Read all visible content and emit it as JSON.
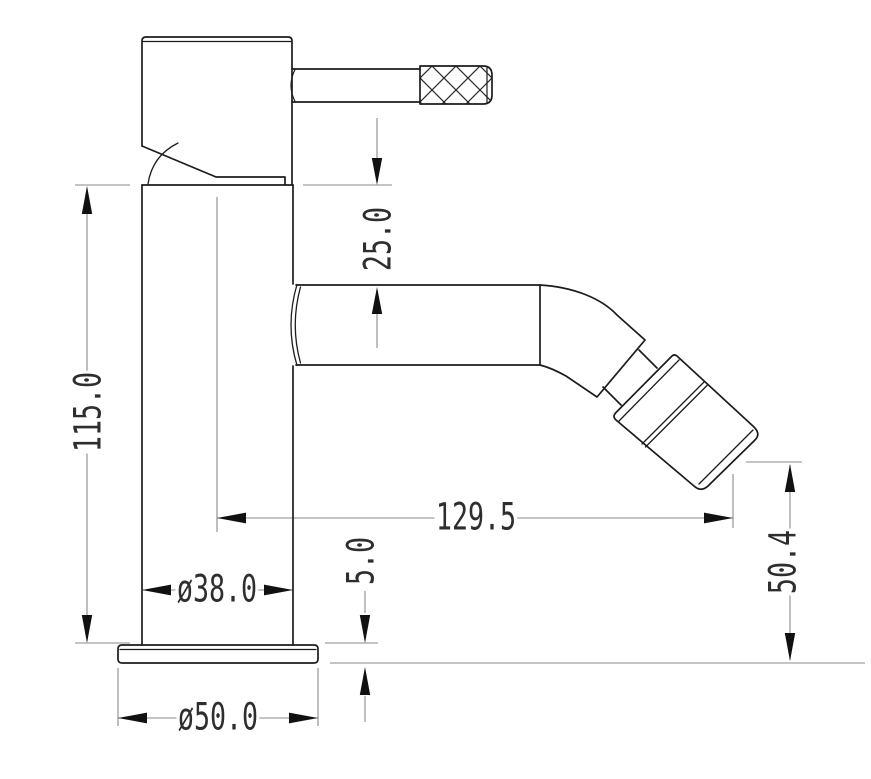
{
  "drawing": {
    "kind": "faucet-technical-drawing",
    "colors": {
      "background": "#ffffff",
      "object_line": "#1c1c1c",
      "thin_line": "#8a8a8a",
      "arrow": "#111111",
      "text": "#2e2e2e"
    }
  },
  "dimensions": [
    {
      "id": "spout-top-offset",
      "label": "25.0",
      "orientation": "vertical"
    },
    {
      "id": "body-height",
      "label": "115.0",
      "orientation": "vertical"
    },
    {
      "id": "spout-reach",
      "label": "129.5",
      "orientation": "horizontal"
    },
    {
      "id": "outlet-height",
      "label": "50.4",
      "orientation": "vertical"
    },
    {
      "id": "base-thickness",
      "label": "5.0",
      "orientation": "vertical"
    },
    {
      "id": "body-diameter",
      "label": "ø38.0",
      "orientation": "horizontal"
    },
    {
      "id": "base-diameter",
      "label": "ø50.0",
      "orientation": "horizontal"
    }
  ]
}
